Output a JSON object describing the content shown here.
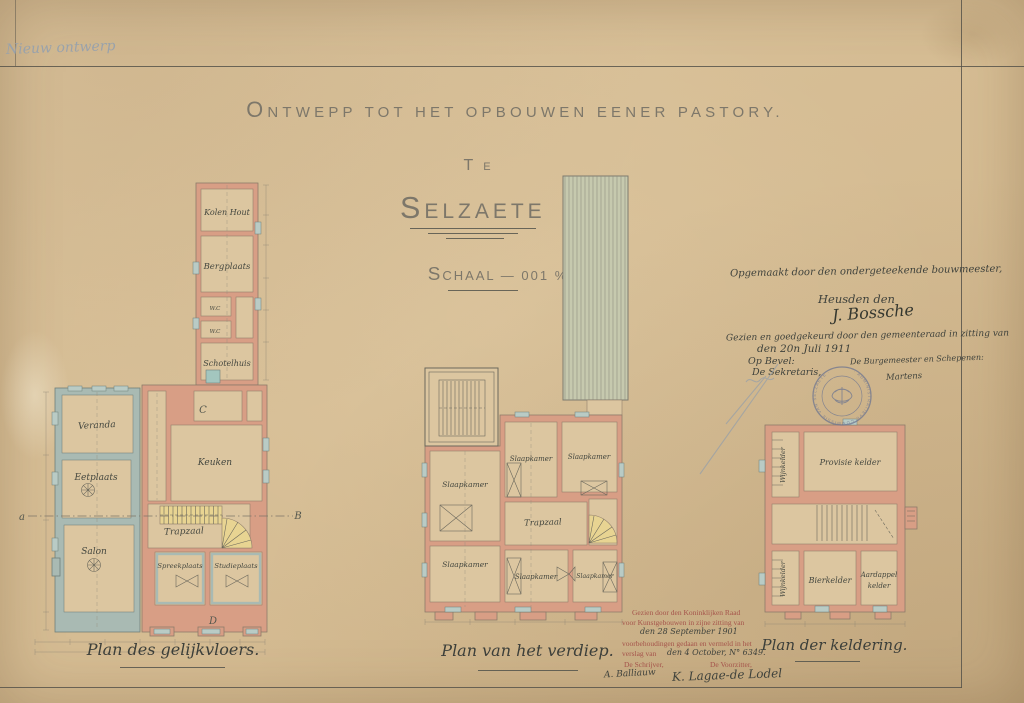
{
  "palette": {
    "paper": "#d6bd94",
    "ink": "#5c5950",
    "wall_brick": "#d89e85",
    "wall_stone": "#a9bab3",
    "stair_yellow": "#e8d492",
    "roof_green": "#c6c9ae",
    "print_red": "#a5544b",
    "seal_blue": "#6a7390",
    "pencil_gray": "#99a2ab"
  },
  "annotations": {
    "pencil_note": "Nieuw ontwerp"
  },
  "title": {
    "main": "ONTWEPP TOT HET OPBOUWEN EENER PASTORY.",
    "te": "TE",
    "place": "SELZAETE",
    "scale": "SCHAAL — 001 %"
  },
  "plans": {
    "ground": {
      "caption": "Plan des gelijkvloers.",
      "rooms": {
        "kolen_hout": "Kolen Hout",
        "bergplaats": "Bergplaats",
        "wc": "W.C",
        "schotelhuis": "Schotelhuis",
        "veranda": "Veranda",
        "eetplaats": "Eetplaats",
        "salon": "Salon",
        "keuken": "Keuken",
        "trapzaal": "Trapzaal",
        "spreekplaats": "Spreekplaats",
        "studieplaats": "Studieplaats"
      },
      "markers": {
        "a": "a",
        "b": "B",
        "c": "C",
        "d": "D"
      }
    },
    "floor": {
      "caption": "Plan van het verdiep.",
      "rooms": {
        "slaapkamer": "Slaapkamer",
        "trapzaal": "Trapzaal"
      }
    },
    "cellar": {
      "caption": "Plan der keldering.",
      "rooms": {
        "wijnkelder": "Wijnkelder",
        "provisiekelder": "Provisie kelder",
        "bierkelder": "Bierkelder",
        "aardappel_line1": "Aardappel",
        "aardappel_line2": "kelder"
      }
    }
  },
  "approval": {
    "architect_line": "Opgemaakt door den ondergeteekende bouwmeester,",
    "place_date": "Heusden den",
    "architect_signature": "J. Bossche",
    "council_line": "Gezien en goedgekeurd door den gemeenteraad in zitting van",
    "council_date": "den 20n Juli 1911",
    "op_bevel": "Op Bevel:",
    "secretary": "De Sekretaris,",
    "mayor": "De Burgemeester en Schepenen:",
    "mayor_signature": "Martens"
  },
  "royal_commission_stamp": {
    "line1": "Gezien door den Koninklijken Raad",
    "line2": "voor Kunstgebouwen in zijne zitting van",
    "date1": "den 28 September 1901",
    "line3": "voorbehoudingen gedaan en vermeld in het",
    "line4": "verslag van",
    "date2": "den 4 October, N° 6349.",
    "secretary": "De Schrijver,",
    "president": "De Voorzitter,",
    "secretary_signature": "A. Balliauw",
    "president_signature": "K. Lagae-de Lodel"
  },
  "seal": {
    "text": "· ADMINISTRATIEVE COMMISSIE VAN SELZAETE ·"
  }
}
